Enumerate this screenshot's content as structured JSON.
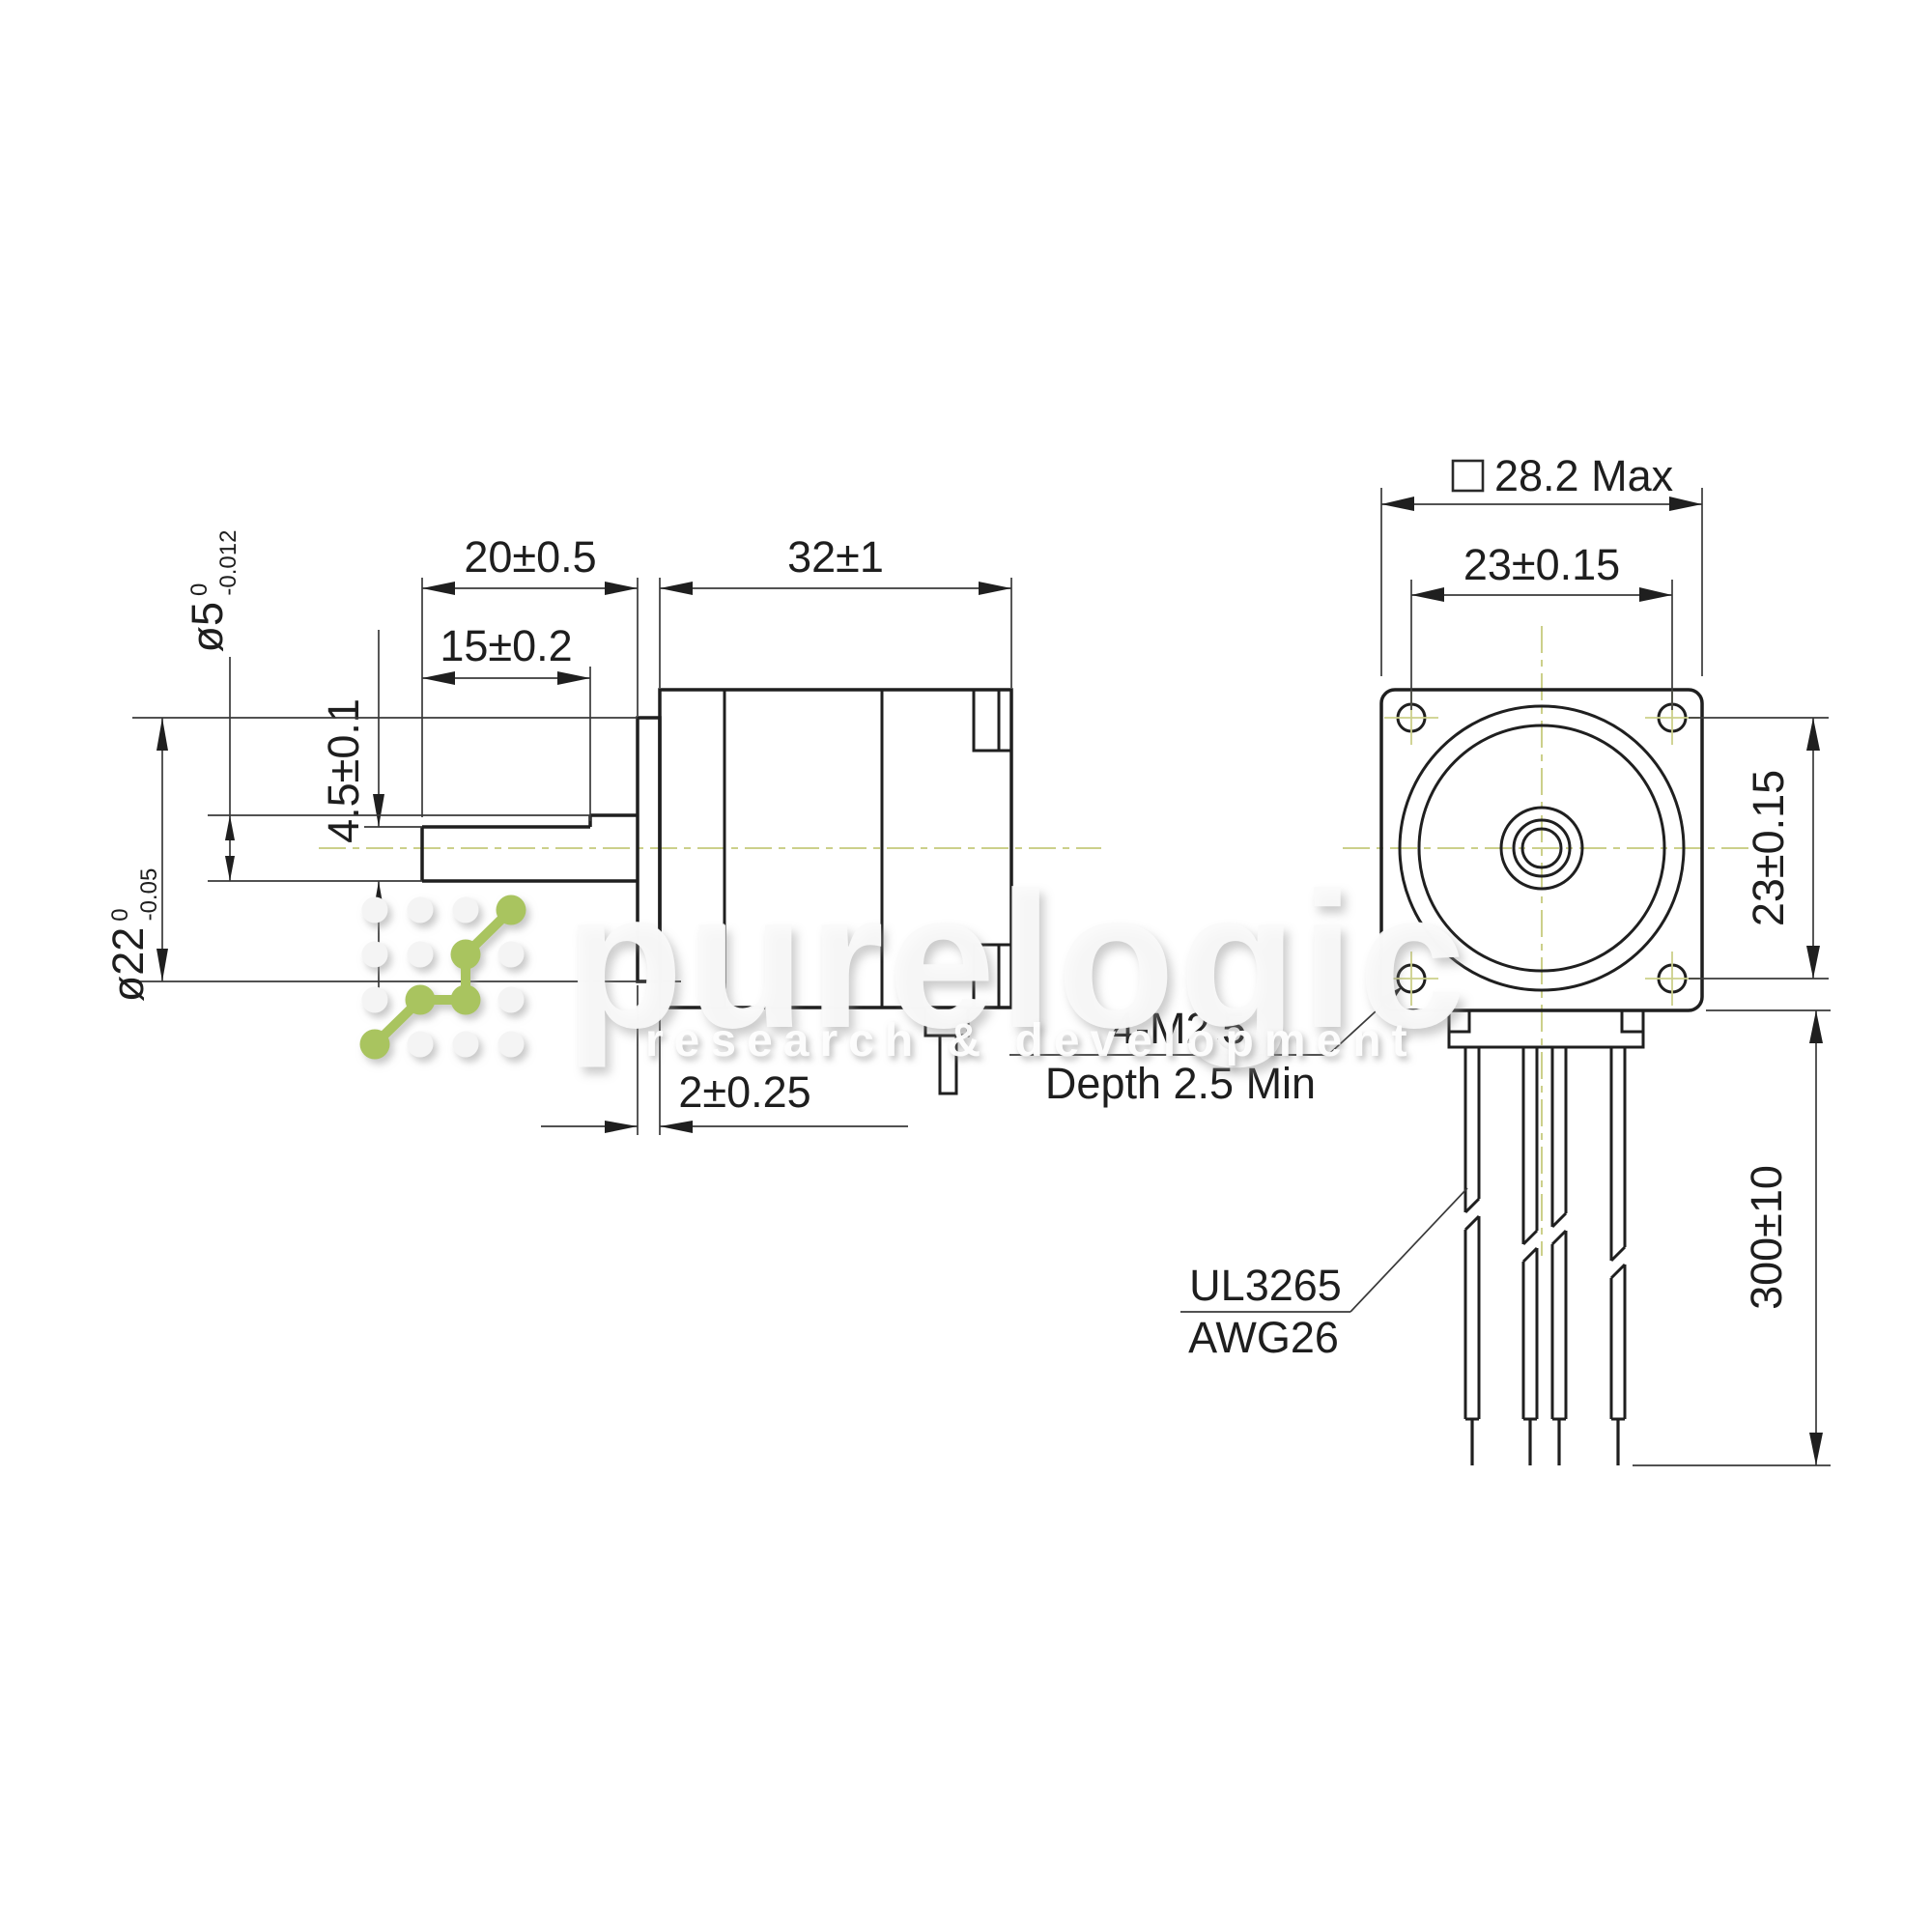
{
  "side_view": {
    "dims": {
      "shaft_length": "20±0.5",
      "body_length": "32±1",
      "flat_length": "15±0.2",
      "flat_depth": "4.5±0.1",
      "boss_width": "2±0.25"
    },
    "shaft_diameter": {
      "main": "ø5",
      "tol_upper": "0",
      "tol_lower": "-0.012"
    },
    "boss_diameter": {
      "main": "ø22",
      "tol_upper": "0",
      "tol_lower": "-0.05"
    }
  },
  "front_view": {
    "dims": {
      "body_width_max": "28.2 Max",
      "hole_spacing_horizontal": "23±0.15",
      "hole_spacing_vertical": "23±0.15",
      "wire_length": "300±10"
    },
    "mounting_note": {
      "line1": "4-M2.5",
      "line2": "Depth 2.5 Min"
    },
    "wire_spec": {
      "line1": "UL3265",
      "line2": "AWG26"
    }
  },
  "watermark": {
    "brand": "purelogic",
    "tagline": "research & development"
  },
  "colors": {
    "line": "#1f1f1f",
    "dim_line": "#3a3a3a",
    "centerline": "#ccd08a",
    "logo_green": "#a9c45f"
  }
}
